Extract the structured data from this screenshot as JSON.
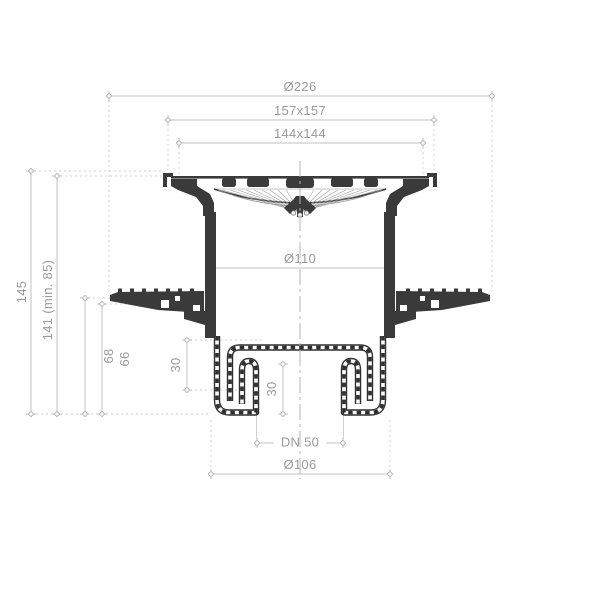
{
  "drawing": {
    "subject": "floor-drain-vertical-outlet-cross-section",
    "background": "#ffffff",
    "colors": {
      "part": "#3a3a3a",
      "part_rail": "#2f2f2f",
      "dimension_line": "#c0c0c0",
      "marker": "#b3b3b3",
      "dimension_text": "#9b9b9b",
      "centerline": "#b5b5b5",
      "hatch": "#9a9a9a"
    },
    "dimensions": {
      "top": [
        {
          "label": "Ø226"
        },
        {
          "label": "157x157"
        },
        {
          "label": "144x144"
        }
      ],
      "left": [
        {
          "label": "145"
        },
        {
          "label": "141 (min. 85)"
        },
        {
          "label": "68"
        },
        {
          "label": "66"
        }
      ],
      "inner": [
        {
          "label": "Ø110"
        },
        {
          "label": "30"
        },
        {
          "label": "30"
        }
      ],
      "bottom": [
        {
          "label": "DN 50"
        },
        {
          "label": "Ø106"
        }
      ]
    }
  }
}
